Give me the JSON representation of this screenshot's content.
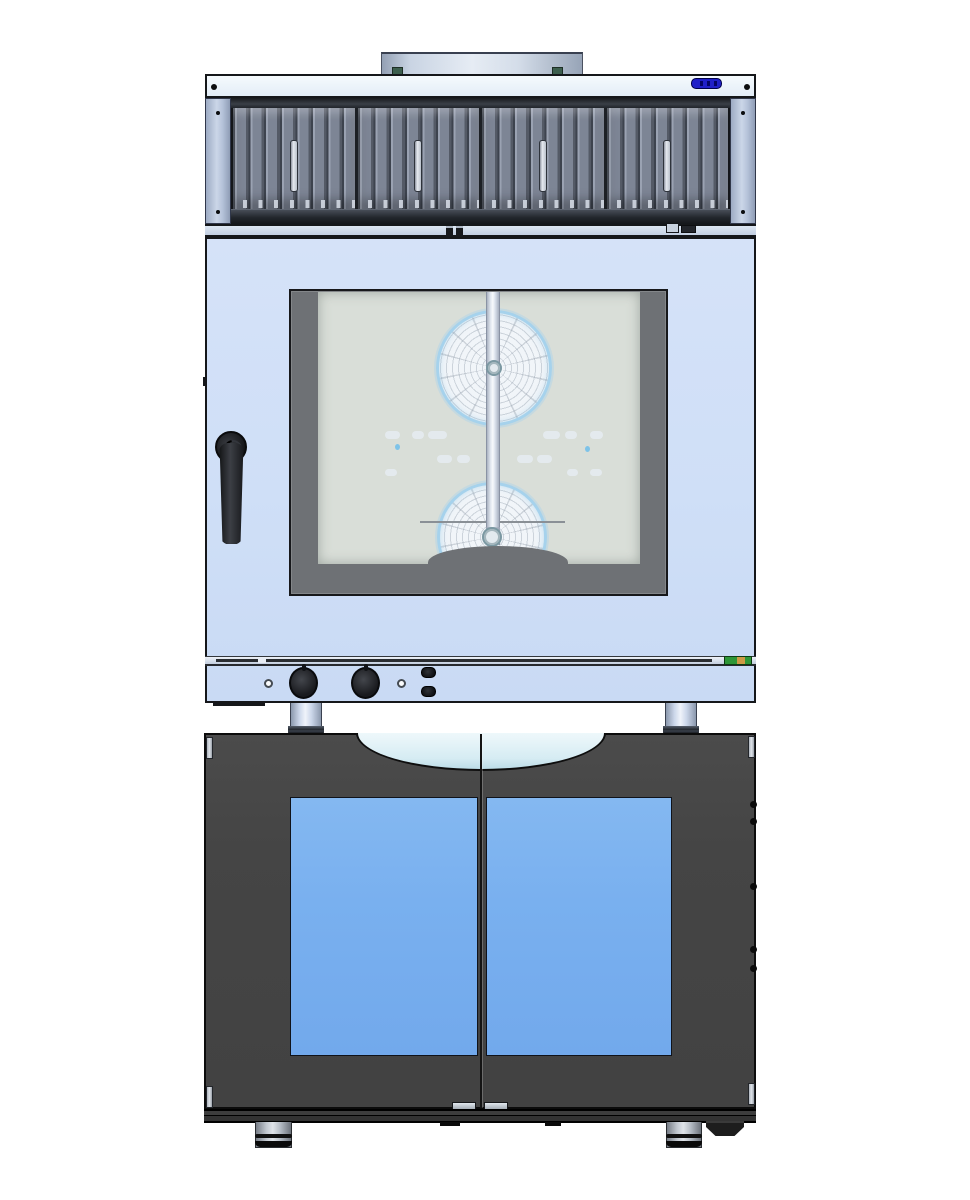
{
  "title": "Front-view CAD render: ventilation hood on combi oven on base cabinet",
  "hood": {
    "name": "condensation-ventilation-hood",
    "filter_panels": 4,
    "has_exhaust_duct": true,
    "display": {
      "name": "mini-digital-display",
      "color": "#2020c8"
    }
  },
  "oven": {
    "name": "combi-convection-oven",
    "fan_count": 2,
    "door_handle_side": "left",
    "controls": {
      "indicator_lights": 2,
      "knobs": 2,
      "buttons": 2
    },
    "rating_label_colors": [
      "#2e9637",
      "#cd9a45"
    ]
  },
  "cabinet": {
    "name": "base-proofer-cabinet",
    "doors": 2,
    "feet": 2,
    "glass_color": "#79b0ef"
  },
  "colors": {
    "body_blue": "#cfdff7",
    "hood_top": "#eef5fc",
    "filter_gray": "#7d8595",
    "cabinet_dark": "#454545",
    "glass_blue": "#79b0ef",
    "scoop_light": "#d6ecf3",
    "fan_rim": "#a6d2ec",
    "cavity": "#d9ded8",
    "frame_gray": "#6e7175",
    "display_blue": "#2020c8",
    "label_green": "#2e9637",
    "label_orange": "#cd9a45",
    "handle_black": "#1b1c1f"
  }
}
